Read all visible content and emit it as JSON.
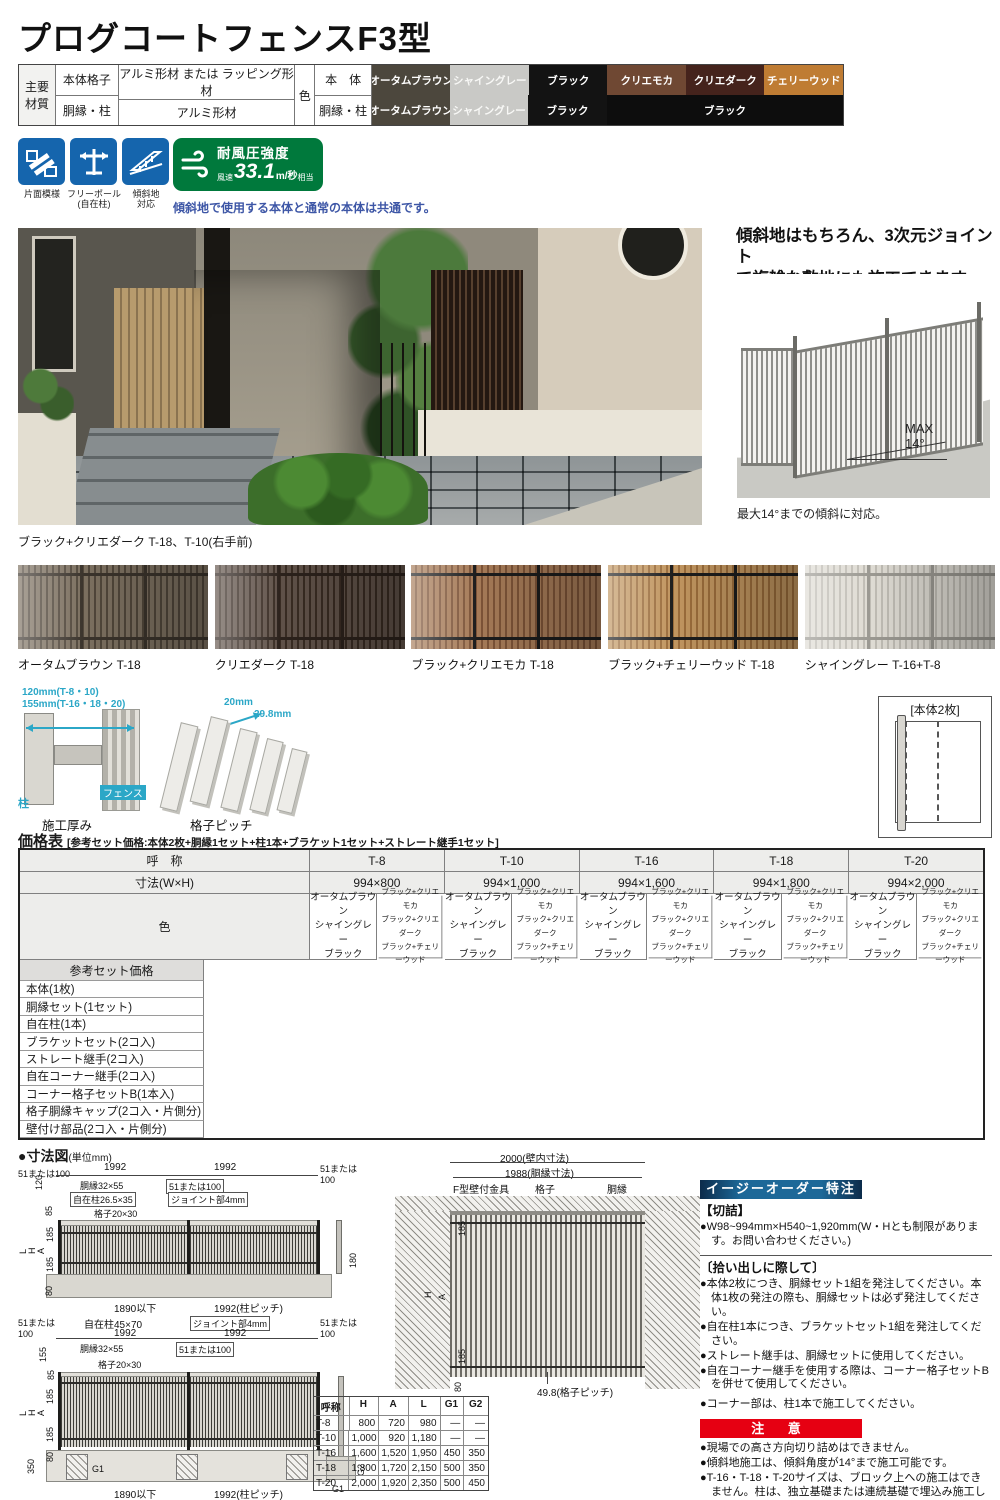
{
  "page": {
    "title": "プログコートフェンスF3型"
  },
  "colors": {
    "accent_blue": "#1565ad",
    "badge_green": "#00793c",
    "cyan": "#2ba7c7",
    "note_blue": "#3d56a6",
    "red": "#e60012",
    "bar_blue": "#1d6898"
  },
  "materials": {
    "header": "主要材質",
    "rows": [
      {
        "label": "本体格子",
        "value": "アルミ形材 または ラッピング形材"
      },
      {
        "label": "胴縁・柱",
        "value": "アルミ形材"
      }
    ],
    "color_label": "色",
    "body_label": "本　体",
    "frame_label": "胴縁・柱",
    "body_swatches": [
      {
        "name": "オータムブラウン",
        "bg": "#4c473d",
        "fg": "#ffffff"
      },
      {
        "name": "シャイングレー",
        "bg": "#c9c9c6",
        "fg": "#f8f8f6"
      },
      {
        "name": "ブラック",
        "bg": "#131313",
        "fg": "#ffffff"
      },
      {
        "name": "クリエモカ",
        "bg": "#6f4833",
        "fg": "#ffffff"
      },
      {
        "name": "クリエダーク",
        "bg": "#45231c",
        "fg": "#ffffff"
      },
      {
        "name": "チェリーウッド",
        "bg": "#bf7c33",
        "fg": "#ffffff"
      }
    ],
    "frame_swatches": [
      {
        "name": "オータムブラウン",
        "bg": "#4c473d",
        "fg": "#ffffff",
        "w": 78
      },
      {
        "name": "シャイングレー",
        "bg": "#c9c9c6",
        "fg": "#f8f8f6",
        "w": 78
      },
      {
        "name": "ブラック",
        "bg": "#131313",
        "fg": "#ffffff",
        "w": 79
      },
      {
        "name": "ブラック",
        "bg": "#0d0d0d",
        "fg": "#ffffff",
        "w": 236
      }
    ]
  },
  "features": [
    {
      "label": "片面模様"
    },
    {
      "label": "フリーポール\n(自在柱)"
    },
    {
      "label": "傾斜地\n対応"
    }
  ],
  "wind_badge": {
    "title": "耐風圧強度",
    "prefix": "風速",
    "value": "33.1",
    "unit": "m/秒",
    "suffix": "相当"
  },
  "slope_note": "傾斜地で使用する本体と通常の本体は共通です。",
  "main_photo": {
    "caption": "ブラック+クリエダーク T-18、T-10(右手前)"
  },
  "slope_section": {
    "heading": "傾斜地はもちろん、3次元ジョイント\nで複雑な敷地にも施工できます。",
    "max_label": "MAX\n14°",
    "caption": "最大14°までの傾斜に対応。"
  },
  "color_photos": [
    {
      "caption": "オータムブラウン  T-18",
      "slat": "#7b6f5f",
      "gap": "#50463a",
      "frame": "#3a332b"
    },
    {
      "caption": "クリエダーク  T-18",
      "slat": "#5f5148",
      "gap": "#382b22",
      "frame": "#2b211b"
    },
    {
      "caption": "ブラック+クリエモカ  T-18",
      "slat": "#a57a57",
      "gap": "#7c5337",
      "frame": "#1c1c1c"
    },
    {
      "caption": "ブラック+チェリーウッド T-18",
      "slat": "#c0955f",
      "gap": "#9a6c3b",
      "frame": "#1c1c1c"
    },
    {
      "caption": "シャイングレー  T-16+T-8",
      "slat": "#dedbd3",
      "gap": "#bfbcb4",
      "frame": "#9a9891"
    }
  ],
  "thickness_diagram": {
    "dim1": "120mm(T-8・10)",
    "dim2": "155mm(T-16・18・20)",
    "post_label": "柱",
    "fence_label": "フェンス",
    "caption": "施工厚み"
  },
  "pitch_diagram": {
    "dim1": "20mm",
    "dim2": "29.8mm",
    "caption": "格子ピッチ"
  },
  "panel_set": {
    "label": "[本体2枚]"
  },
  "price": {
    "title": "価格表",
    "subtitle": "[参考セット価格:本体2枚+胴縁1セット+柱1本+ブラケット1セット+ストレート継手1セット]",
    "col_name_label": "呼　称",
    "col_size_label": "寸法(W×H)",
    "color_label": "色",
    "set_price_label": "参考セット価格",
    "columns": [
      {
        "name": "T-8",
        "size": "994×800"
      },
      {
        "name": "T-10",
        "size": "994×1,000"
      },
      {
        "name": "T-16",
        "size": "994×1,600"
      },
      {
        "name": "T-18",
        "size": "994×1,800"
      },
      {
        "name": "T-20",
        "size": "994×2,000"
      }
    ],
    "color_group_a": "オータムブラウン\nシャイングレー\nブラック",
    "color_group_b": "ブラック+クリエモカ\nブラック+クリエダーク\nブラック+チェリーウッド",
    "items": [
      "本体(1枚)",
      "胴縁セット(1セット)",
      "自在柱(1本)",
      "ブラケットセット(2コ入)",
      "ストレート継手(2コ入)",
      "自在コーナー継手(2コ入)",
      "コーナー格子セットB(1本入)",
      "格子胴縁キャップ(2コ入・片側分)",
      "壁付け部品(2コ入・片側分)"
    ]
  },
  "dims": {
    "title": "●寸法図",
    "unit": "(単位mm)",
    "d1": {
      "tl": "51または100",
      "span1": "1992",
      "span2": "1992",
      "tr": "51または\n100",
      "dobuchi": "胴縁32×55",
      "mid51": "51または100",
      "jizai": "自在柱26.5×35",
      "joint": "ジョイント部4mm",
      "koshi": "格子20×30",
      "dim120": "120",
      "dim85": "85",
      "L": "L",
      "H": "H",
      "A": "A",
      "d185a": "185",
      "d185b": "185",
      "d80": "80",
      "d180": "180",
      "bottom1": "1890以下",
      "bottom2": "1992(柱ピッチ)"
    },
    "d2": {
      "tl": "51または\n100",
      "jizai": "自在柱45×70",
      "joint": "ジョイント部4mm",
      "tr": "51または\n100",
      "span1": "1992",
      "span2": "1992",
      "dobuchi": "胴縁32×55",
      "mid51": "51または100",
      "dim155": "155",
      "dim85": "85",
      "L": "L",
      "H": "H",
      "A": "A",
      "d185a": "185",
      "d185b": "185",
      "dim350": "350",
      "d80": "80",
      "g1": "G1",
      "g1b": "G1",
      "g2": "G2",
      "koshi": "格子20×30",
      "bottom1": "1890以下",
      "bottom2": "1992(柱ピッチ)"
    },
    "wall": {
      "dim2000": "2000(壁内寸法)",
      "dim1988": "1988(胴縁寸法)",
      "kanagu": "F型壁付金具",
      "koshi": "格子",
      "dobuchi": "胴縁",
      "d185a": "185",
      "H": "H",
      "A": "A",
      "d185b": "185",
      "d80": "80",
      "pitch": "49.8(格子ピッチ)"
    },
    "size_table": {
      "headers": [
        "呼称",
        "H",
        "A",
        "L",
        "G1",
        "G2"
      ],
      "rows": [
        [
          "T-8",
          "800",
          "720",
          "980",
          "—",
          "—"
        ],
        [
          "T-10",
          "1,000",
          "920",
          "1,180",
          "—",
          "—"
        ],
        [
          "T-16",
          "1,600",
          "1,520",
          "1,950",
          "450",
          "350"
        ],
        [
          "T-18",
          "1,800",
          "1,720",
          "2,150",
          "500",
          "350"
        ],
        [
          "T-20",
          "2,000",
          "1,920",
          "2,350",
          "500",
          "450"
        ]
      ]
    }
  },
  "easy_order": {
    "header": "イージーオーダー特注",
    "sec1_title": "【切詰】",
    "sec1_items": [
      "●W98~994mm×H540~1,920mm(W・Hとも制限があります。お問い合わせください。)"
    ],
    "sec2_title": "〔拾い出しに際して〕",
    "sec2_items": [
      "●本体2枚につき、胴縁セット1組を発注してください。本体1枚の発注の際も、胴縁セットは必ず発注してください。",
      "●自在柱1本につき、ブラケットセット1組を発注してください。",
      "●ストレート継手は、胴縁セットに使用してください。",
      "●自在コーナー継手を使用する際は、コーナー格子セットBを併せて使用してください。"
    ],
    "corner_note": "●コーナー部は、柱1本で施工してください。"
  },
  "caution": {
    "header": "注 意",
    "items": [
      "●現場での高さ方向切り詰めはできません。",
      "●傾斜地施工は、傾斜角度が14°まで施工可能です。",
      "●T-16・T-18・T-20サイズは、ブロック上への施工はできません。柱は、独立基礎または連続基礎で埋込み施工してください。",
      "●所定の柱取付ピッチで施工してください。所定寸法を外れると製品強度が維持できなくなります。"
    ]
  }
}
